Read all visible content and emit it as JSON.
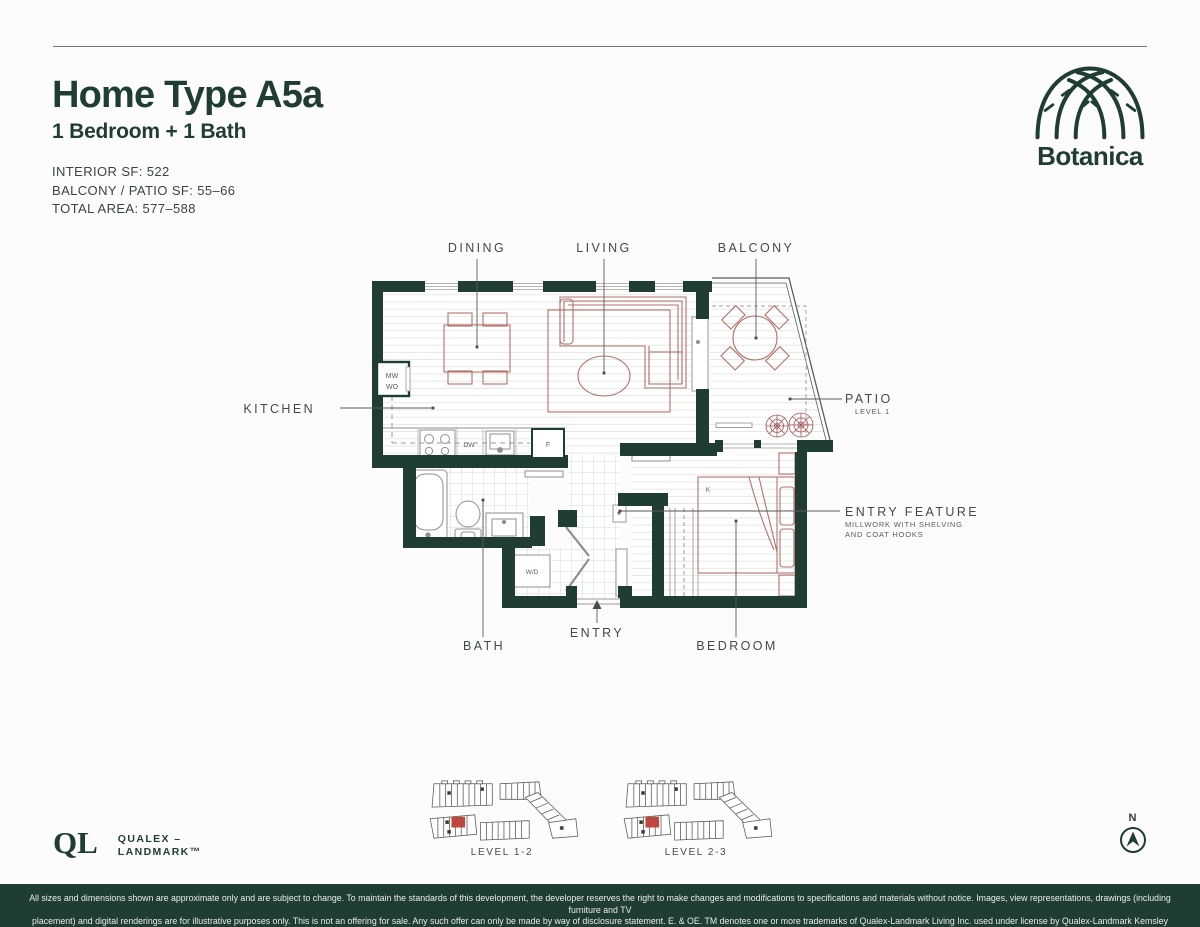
{
  "colors": {
    "brand_green": "#1f3d33",
    "furniture_red": "#b5716b",
    "plant_red": "#a4565a",
    "keyplan_unit_red": "#c0473f",
    "page_bg": "#fcfcfa"
  },
  "header": {
    "title": "Home Type A5a",
    "subtitle": "1 Bedroom + 1 Bath",
    "specs": {
      "interior": "INTERIOR SF: 522",
      "balcony_patio": "BALCONY / PATIO SF: 55–66",
      "total": "TOTAL AREA: 577–588"
    }
  },
  "brand": {
    "name": "Botanica"
  },
  "plan": {
    "labels": {
      "dining": "DINING",
      "living": "LIVING",
      "balcony": "BALCONY",
      "kitchen": "KITCHEN",
      "patio": "PATIO",
      "patio_sub": "LEVEL 1",
      "entry_feature": "ENTRY FEATURE",
      "entry_feature_sub1": "MILLWORK WITH SHELVING",
      "entry_feature_sub2": "AND COAT HOOKS",
      "bath": "BATH",
      "entry": "ENTRY",
      "bedroom": "BEDROOM"
    },
    "fixtures": {
      "microwave": "MW",
      "wall_oven": "WO",
      "dishwasher": "DW",
      "fridge": "F",
      "washer_dryer": "W/D",
      "bed": "K"
    }
  },
  "keyplans": [
    {
      "label": "LEVEL 1-2"
    },
    {
      "label": "LEVEL 2-3"
    }
  ],
  "developer": {
    "monogram": "QL",
    "line1": "QUALEX –",
    "line2": "LANDMARK™"
  },
  "compass": {
    "label": "N"
  },
  "footer": {
    "line1": "All sizes and dimensions shown are approximate only and are subject to change. To maintain the standards of this development, the developer reserves the right to make changes and modifications to specifications and materials without notice. Images, view representations, drawings (including furniture and TV",
    "line2": "placement) and digital renderings are for illustrative purposes only. This is not an offering for sale. Any such offer can only be made by way of disclosure statement. E. & OE. TM denotes one or more trademarks of Qualex-Landmark Living Inc. used under license by Qualex-Landmark Kemsley Limited Partnership."
  }
}
